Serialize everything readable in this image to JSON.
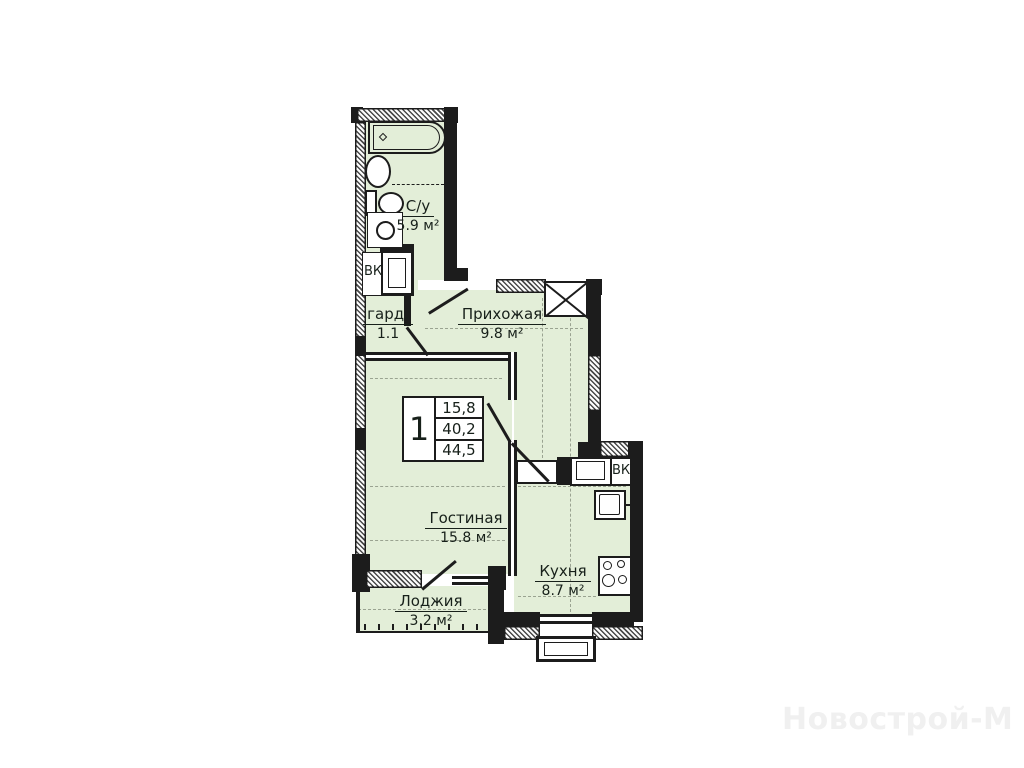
{
  "plan": {
    "rooms": [
      {
        "name": "С/у",
        "area": "5.9 м²"
      },
      {
        "name": "гард.",
        "area": "1.1"
      },
      {
        "name": "Прихожая",
        "area": "9.8 м²"
      },
      {
        "name": "Гостиная",
        "area": "15.8 м²"
      },
      {
        "name": "Кухня",
        "area": "8.7 м²"
      },
      {
        "name": "Лоджия",
        "area": "3.2 м²"
      }
    ],
    "info_table": {
      "rooms_count": "1",
      "values": [
        "15,8",
        "40,2",
        "44,5"
      ]
    },
    "duct_labels": {
      "bathroom": "ВК",
      "kitchen": "ВК"
    },
    "watermark": "Новострой-М",
    "colors": {
      "room_fill": "#e3eed8",
      "wall": "#1c1c1c",
      "axis_dash": "#9aa391",
      "watermark": "#f0f0f0"
    }
  }
}
